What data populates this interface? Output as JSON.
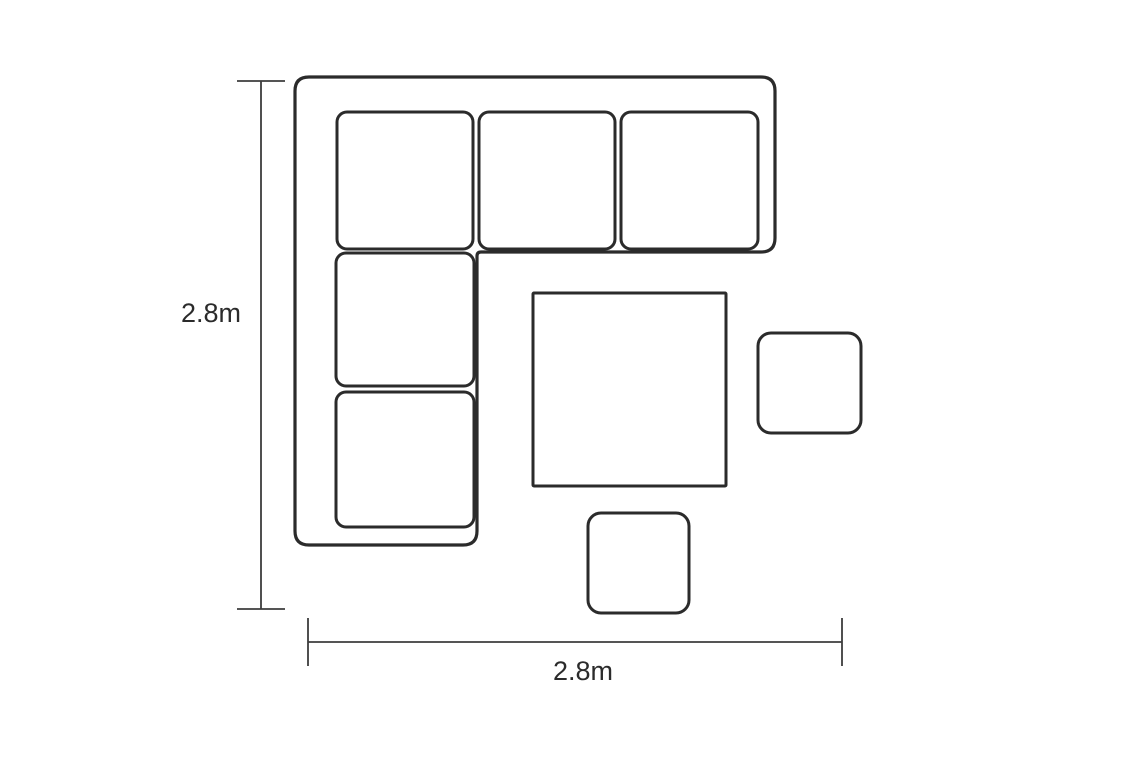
{
  "page": {
    "background": "#ffffff",
    "kind": "furniture-dimension-plan"
  },
  "colors": {
    "furniture_outline": "#2b2b2b",
    "dimension_line": "#3d3d3d",
    "label_text": "#2b2b2b",
    "fill": "#ffffff"
  },
  "diagram": {
    "canvas": {
      "width": 1138,
      "height": 757
    },
    "pieces": [
      {
        "name": "corner-sofa-outline",
        "shape": "path",
        "d": "M 309 77 L 761 77 Q 775 77 775 91 L 775 238 Q 775 252 761 252 L 481 252 Q 477 252 477 256 L 477 531 Q 477 545 463 545 L 309 545 Q 295 545 295 531 L 295 91 Q 295 77 309 77 Z",
        "sw": 3.2
      },
      {
        "name": "seat-cushion-corner",
        "shape": "rect",
        "x": 337,
        "y": 112,
        "w": 136,
        "h": 137,
        "rx": 10,
        "sw": 3
      },
      {
        "name": "seat-cushion-top-middle",
        "shape": "rect",
        "x": 479,
        "y": 112,
        "w": 136,
        "h": 137,
        "rx": 10,
        "sw": 3
      },
      {
        "name": "seat-cushion-top-right",
        "shape": "rect",
        "x": 621,
        "y": 112,
        "w": 137,
        "h": 137,
        "rx": 10,
        "sw": 3
      },
      {
        "name": "seat-cushion-left-middle",
        "shape": "rect",
        "x": 336,
        "y": 253,
        "w": 138,
        "h": 133,
        "rx": 10,
        "sw": 3
      },
      {
        "name": "seat-cushion-left-bottom",
        "shape": "rect",
        "x": 336,
        "y": 392,
        "w": 138,
        "h": 135,
        "rx": 10,
        "sw": 3
      },
      {
        "name": "table",
        "shape": "rect",
        "x": 533,
        "y": 293,
        "w": 193,
        "h": 193,
        "rx": 1,
        "sw": 3
      },
      {
        "name": "stool-right",
        "shape": "rect",
        "x": 758,
        "y": 333,
        "w": 103,
        "h": 100,
        "rx": 13,
        "sw": 3
      },
      {
        "name": "stool-bottom",
        "shape": "rect",
        "x": 588,
        "y": 513,
        "w": 101,
        "h": 100,
        "rx": 13,
        "sw": 3
      }
    ],
    "dimensions": [
      {
        "name": "height-dimension",
        "orientation": "vertical",
        "label": "2.8m",
        "axis": 261,
        "from": 81,
        "to": 609,
        "tick_half": 24,
        "sw": 1.8
      },
      {
        "name": "width-dimension",
        "orientation": "horizontal",
        "label": "2.8m",
        "axis": 642,
        "from": 308,
        "to": 842,
        "tick_half": 24,
        "sw": 1.8
      }
    ]
  }
}
